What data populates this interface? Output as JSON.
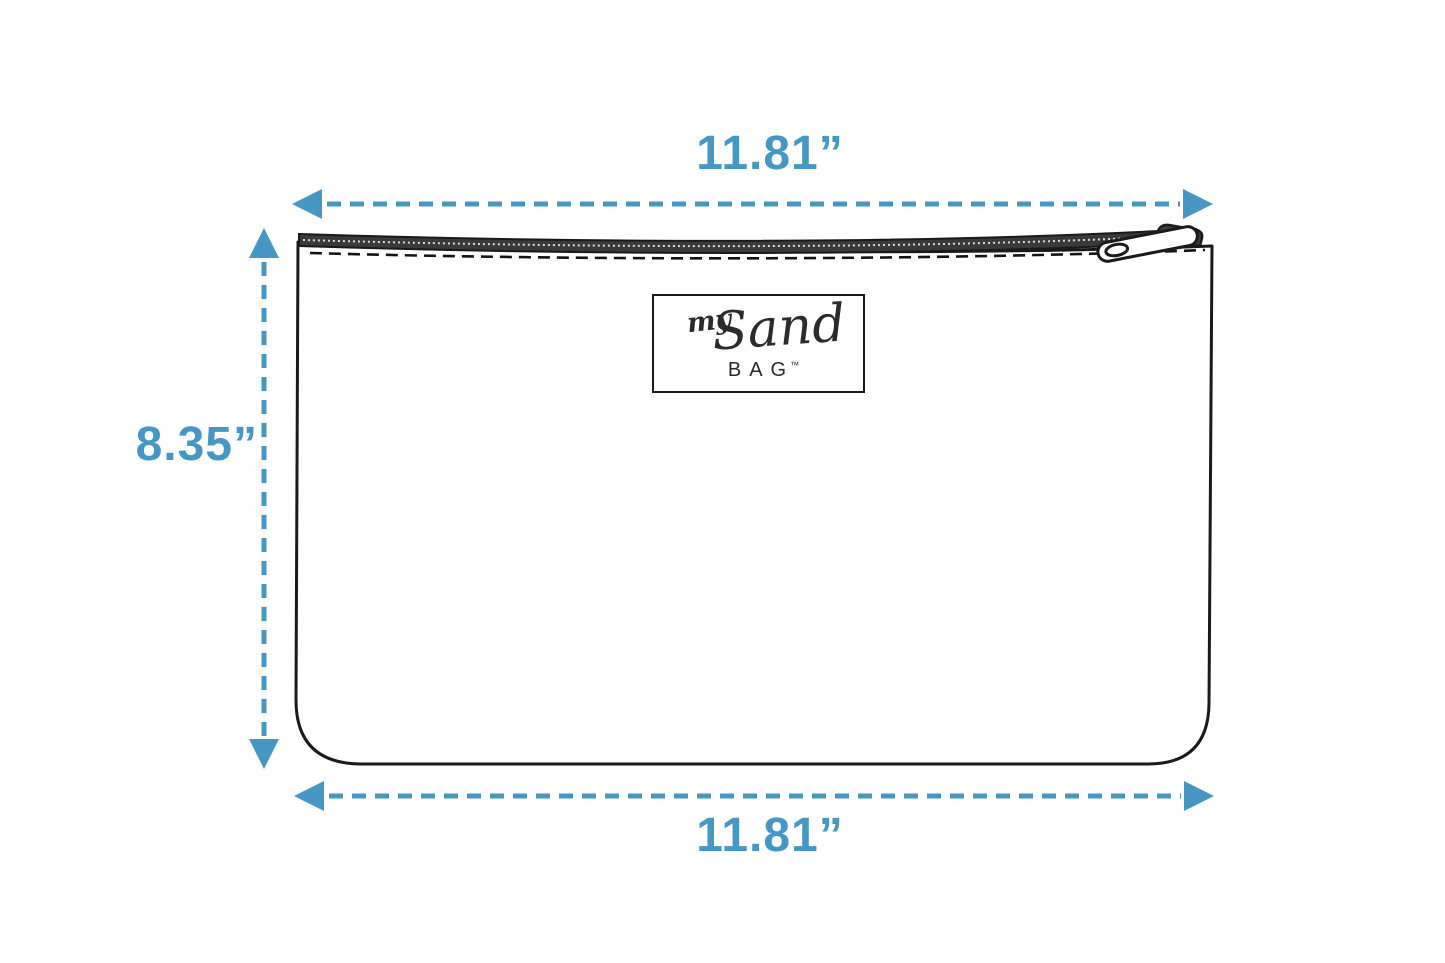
{
  "diagram": {
    "dimensions": {
      "top_width": "11.81”",
      "height": "8.35”",
      "bottom_width": "11.81”"
    },
    "logo": {
      "word_my": "my",
      "word_sand": "Sand",
      "word_bag": "BAG",
      "trademark": "™"
    },
    "colors": {
      "accent_blue": "#4697c4",
      "outline_ink": "#1a1a1a",
      "zipper_dark": "#3a3a3a",
      "background": "#ffffff"
    }
  }
}
